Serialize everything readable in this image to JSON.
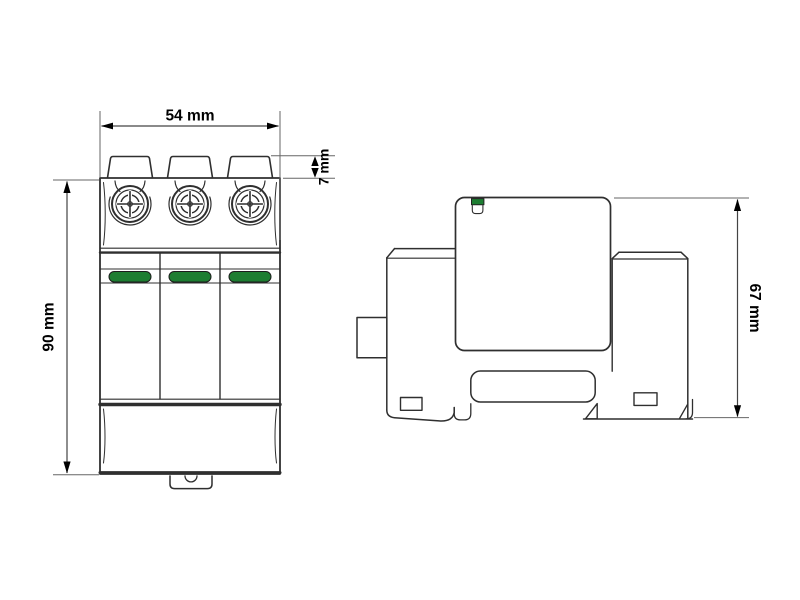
{
  "drawing": {
    "type": "dimensional-drawing",
    "front_view": {
      "width_label": "54 mm",
      "terminal_height_label": "7 mm",
      "height_label": "90 mm",
      "indicator_color": "#1d7d31",
      "pole_count": 3
    },
    "side_view": {
      "depth_label": "67 mm",
      "indicator_color": "#1d7d31"
    },
    "line_color": "#2f2f2f",
    "dimension_line_color": "#555555"
  }
}
